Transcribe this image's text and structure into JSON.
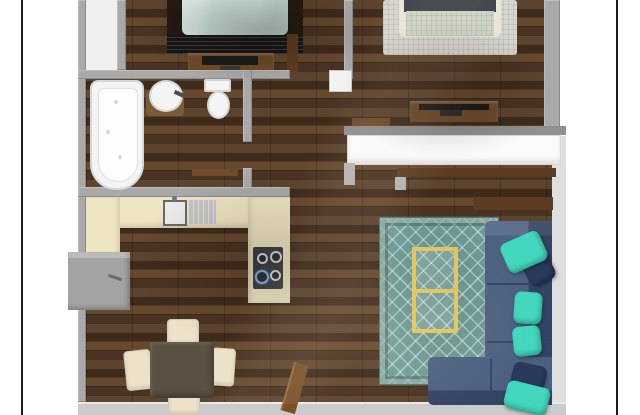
{
  "scene": {
    "description": "3D top-down rendering of an apartment floor plan in a white frame",
    "frame": {
      "matte": "#ffffff",
      "border_line": "#1a1a1a"
    },
    "palette": {
      "floor_wood": "#543c28",
      "wall_gray": "#a9a9a9",
      "wall_dark_gray": "#8f8f8f",
      "wall_bottom_gray": "#cbcbcb",
      "wall_white": "#dfdfdf",
      "closet_floor_white": "#efefef",
      "fixture_white": "#f4f4f4",
      "counter_cream": "#eee5c3",
      "drainboard_steel": "#c6c6c6",
      "stove_top_charcoal": "#3d3d42",
      "fridge_gray": "#a3a3a3",
      "bed1_blanket_mint": "#cfe9e1",
      "bed1_frame_dark": "#241a12",
      "bed1_rug_black": "#1a1a1a",
      "wood_furniture_brown": "#6f4b2a",
      "tv_black": "#1b1b1b",
      "bed2_blanket_sage": "#ccd3c4",
      "bed2_pillow_charcoal": "#3a3f49",
      "bed2_frame_cream": "#e9e5da",
      "bed2_rug_gray": "#d7d5d0",
      "sideboard_white": "#fafafa",
      "shelf_wood_dark": "#5c3d22",
      "sofa_navy": "#3e5478",
      "pillow_teal": "#43d8bd",
      "pillow_navy": "#2b3a5c",
      "rug_teal": "#6f9e98",
      "coffee_table_gold": "#e3c45c",
      "dining_table_brown": "#5b5142",
      "chair_cream": "#ebe2c9",
      "door_wood": "#7a5028",
      "door_white": "#f2f2f2"
    },
    "rooms": [
      {
        "name": "bedroom-1",
        "furniture": [
          "bed with mint blanket",
          "dark striped rug",
          "tv stand with tv",
          "side cabinet"
        ]
      },
      {
        "name": "bathroom",
        "furniture": [
          "bathtub",
          "round sink on wood mat",
          "toilet"
        ]
      },
      {
        "name": "kitchen",
        "furniture": [
          "l-shaped cream counter",
          "sink with drainboard",
          "cooktop with 4 burners",
          "refrigerator"
        ]
      },
      {
        "name": "dining-area",
        "furniture": [
          "square table",
          "four cream chairs"
        ]
      },
      {
        "name": "bedroom-2",
        "furniture": [
          "bed with sage blanket",
          "light gray area rug",
          "dresser with tv",
          "white sideboard",
          "wall shelf"
        ]
      },
      {
        "name": "living-room",
        "furniture": [
          "navy sectional sofa",
          "teal pillows",
          "navy pillows",
          "teal diamond rug",
          "gold coffee table",
          "console shelf",
          "sofa table",
          "entry door"
        ]
      }
    ]
  }
}
